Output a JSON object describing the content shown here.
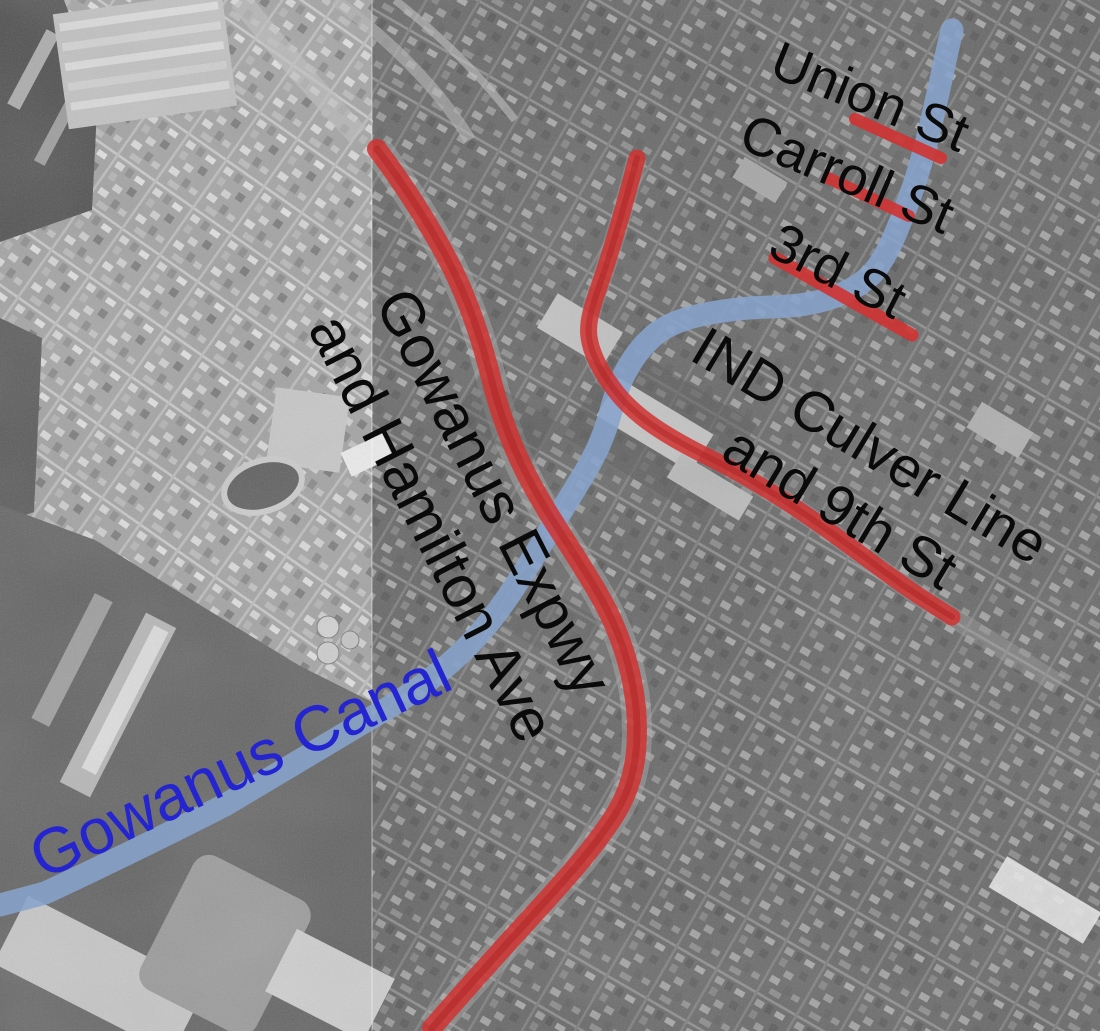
{
  "map_labels": {
    "union_st": "Union St",
    "carroll_st": "Carroll St",
    "third_st": "3rd St",
    "culver_line1": "IND Culver Line",
    "culver_line2": "and 9th St",
    "expwy_line1": "Gowanus Expwy",
    "expwy_line2": "and Hamilton Ave",
    "canal": "Gowanus Canal"
  },
  "colors": {
    "route_red": "#d03232",
    "route_red_dark": "#ab1f1f",
    "canal_blue": "#87a3cb",
    "canal_label_blue": "#2424d0",
    "label_black": "#0a0a0a"
  },
  "highlighted_features": [
    "Gowanus Canal",
    "Gowanus Expwy and Hamilton Ave",
    "IND Culver Line and 9th St",
    "Union St",
    "Carroll St",
    "3rd St"
  ]
}
